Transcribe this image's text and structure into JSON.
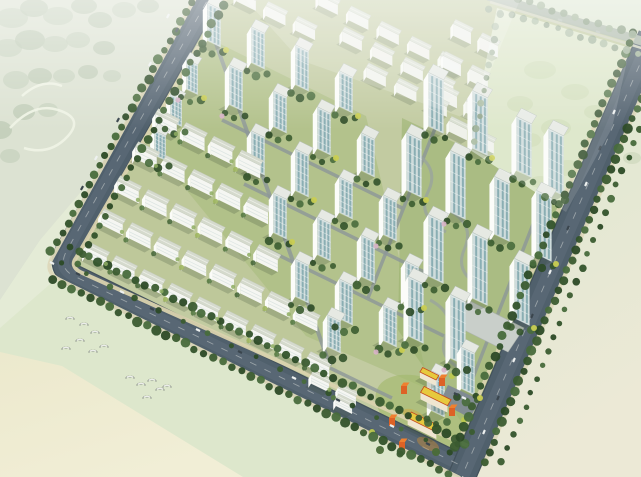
{
  "scene": {
    "kind": "aerial-masterplan-rendering",
    "palette": {
      "bg": "#eef1e2",
      "site_base": "#c2cba1",
      "road": "#50606c",
      "road_dark": "#43515b",
      "road_light": "#5d6d79",
      "ne_road": "#aab6a8",
      "sidewalk_in": "#d9d2ae",
      "sidewalk_out": "#ddd8ba",
      "tree_dark": [
        "#2c4a26",
        "#3b5c30",
        "#486c3c",
        "#33532b"
      ],
      "tree_muted": [
        "#93a88c",
        "#a3b69a",
        "#879c80"
      ],
      "tree_row": [
        "#567a43",
        "#48683a",
        "#9fb65f"
      ],
      "accent_yellow": "#c9ce52",
      "accent_pink": "#d8b2c8",
      "wall": "#f5f6f2",
      "wall_end": "#fbfcf9",
      "wall_faded": "#f3f5f1",
      "roof_slab": "#d5dacd",
      "roof_slab_faded": "#dde2d8",
      "roof_tower": "#e6e9e3",
      "window_face": "#cfdcdc",
      "window_stripe": "#7ea6ad",
      "floor_line": "#d8e2df",
      "shadow": "rgba(55,75,50,0.22)",
      "school_roof": "#e7c93e",
      "school_wall": "#efe6d0",
      "school_cube": "#dd6226",
      "school_cube_roof": "#ef8030",
      "school_trim": "#c44a1e",
      "plaza": "#7e8994",
      "field_green_1": "#e4ebd6",
      "field_green_2": "#dde7cc",
      "field_cream_1": "#efecd0",
      "field_cream_2": "#e9e5c2",
      "forest_base": "#ccd6c0",
      "forest_blob_a": "#b2c1a6",
      "forest_blob_b": "#a5b69a",
      "ne_field": "#d9e4c4",
      "ne_blob": "#c8d7ae",
      "car_light": "#eef1f0",
      "car_dark": "#3a454d",
      "car_mid": "#b9c2b8",
      "bird": "#8d948a",
      "path_gray": "#98a39f",
      "street": "#8d9799",
      "podium": "#c9cfca",
      "lawn_low": "#bcc795",
      "lawn_mid": "#a3ba78",
      "lawn_high": "#97b16c"
    },
    "forest": {
      "poly": "0,0 208,0 140,122 40,240 0,300",
      "blobs": [
        [
          12,
          18,
          16,
          10
        ],
        [
          34,
          8,
          14,
          9
        ],
        [
          58,
          16,
          15,
          9
        ],
        [
          84,
          6,
          13,
          8
        ],
        [
          8,
          48,
          14,
          9
        ],
        [
          30,
          40,
          15,
          10
        ],
        [
          55,
          44,
          13,
          8
        ],
        [
          100,
          20,
          12,
          8
        ],
        [
          124,
          10,
          12,
          8
        ],
        [
          148,
          6,
          11,
          7
        ],
        [
          78,
          40,
          12,
          8
        ],
        [
          104,
          48,
          11,
          7
        ],
        [
          16,
          80,
          13,
          9
        ],
        [
          40,
          76,
          12,
          8
        ],
        [
          64,
          76,
          11,
          7
        ],
        [
          88,
          72,
          10,
          7
        ],
        [
          112,
          76,
          9,
          6
        ],
        [
          24,
          112,
          11,
          8
        ],
        [
          48,
          110,
          10,
          7
        ],
        [
          0,
          130,
          12,
          9
        ],
        [
          10,
          156,
          10,
          7
        ]
      ]
    },
    "fields": {
      "left_poly": "0,0 212,0 62,262 50,284 0,330",
      "green_strip_poly": "0,328 50,284 62,276 458,477 0,477",
      "cream_poly": "0,352 62,366 243,477 0,477",
      "right_poly": "641,88 641,477 470,477 479,466",
      "topright_poly": "494,0 641,0 641,40",
      "right_blobs": [
        [
          600,
          104,
          12,
          8
        ],
        [
          622,
          120,
          11,
          7
        ],
        [
          608,
          140,
          10,
          7
        ],
        [
          632,
          158,
          9,
          6
        ],
        [
          596,
          170,
          8,
          6
        ]
      ],
      "ne_field_poly": "497,8 630,48 612,128 566,212 470,150 487,56",
      "ne_blobs": [
        [
          540,
          70,
          16,
          9
        ],
        [
          575,
          92,
          14,
          8
        ],
        [
          520,
          104,
          13,
          8
        ],
        [
          556,
          128,
          15,
          9
        ],
        [
          595,
          112,
          11,
          7
        ],
        [
          530,
          140,
          11,
          7
        ],
        [
          568,
          168,
          13,
          8
        ],
        [
          540,
          182,
          10,
          6
        ]
      ],
      "loops": [
        "M 10,128 q 24,-26 48,-18 q 26,8 10,26 q -18,20 -44,12",
        "M 22,96 q 20,-18 40,-10"
      ]
    },
    "site": {
      "base_poly": "252,-74 645,46 465,463 60,265",
      "lawns": [
        {
          "poly": "158,120 250,166 345,388 72,252",
          "fill": "#bcc795",
          "op": 0.55
        },
        {
          "poly": "200,34 366,116 430,390 306,336 152,148",
          "fill": "#a3ba78",
          "op": 0.5
        },
        {
          "poly": "402,118 582,202 478,446 398,330",
          "fill": "#97b16c",
          "op": 0.55
        }
      ],
      "school_lawn": {
        "cx": 426,
        "cy": 412,
        "rx": 54,
        "ry": 32,
        "rot": 26,
        "fill": "#a3b86d",
        "op": 0.65
      }
    },
    "streets": [
      [
        206,
        22,
        86,
        234,
        4.5
      ],
      [
        214,
        38,
        330,
        366,
        4
      ],
      [
        222,
        120,
        402,
        208,
        3.5
      ],
      [
        244,
        184,
        424,
        272,
        3.5
      ],
      [
        264,
        248,
        444,
        336,
        3.5
      ],
      [
        436,
        126,
        368,
        298,
        3.5
      ],
      [
        548,
        186,
        472,
        380,
        3.5
      ],
      [
        330,
        368,
        392,
        398,
        3.5
      ]
    ],
    "roads": {
      "main": [
        {
          "d": "M 230,-40 L 66,252 Q 58,268 74,276 L 466,468",
          "w": 21
        },
        {
          "d": "M 652,36 L 462,476",
          "w": 26
        }
      ],
      "ne": {
        "d": "M 488,-4 L 652,44",
        "w": 9
      },
      "dashes": [
        "M 230,-40 L 66,252 Q 58,268 74,276 L 466,468",
        "M 652,36 L 462,476"
      ],
      "sidewalks": [
        {
          "d": "M 240,-26 L 76,258 Q 70,266 80,272 L 468,446",
          "w": 4,
          "c": "#d9d2ae"
        },
        {
          "d": "M 216,-40 L 52,258 Q 44,272 60,280 L 460,478",
          "w": 4,
          "c": "#ddd8ba"
        },
        {
          "d": "M 636,30 L 456,448",
          "w": 4,
          "c": "#d9d2ae"
        },
        {
          "d": "M 664,44 L 484,464",
          "w": 4,
          "c": "#ddd8ba"
        },
        {
          "d": "M 490,2 L 648,50",
          "w": 2.5,
          "c": "#cfd2bd"
        }
      ]
    },
    "treerows": [
      [
        213,
        -36,
        49,
        256,
        11,
        4.2,
        "dark"
      ],
      [
        239,
        -24,
        75,
        268,
        11,
        4.0,
        "dark"
      ],
      [
        70,
        247,
        468,
        444,
        10.5,
        4.2,
        "dark"
      ],
      [
        53,
        279,
        456,
        477,
        10.5,
        4.4,
        "dark"
      ],
      [
        62,
        262,
        462,
        459,
        27,
        2.8,
        "dark"
      ],
      [
        634,
        33,
        454,
        450,
        11,
        4.2,
        "dark"
      ],
      [
        663,
        48,
        483,
        465,
        11,
        4.4,
        "dark"
      ],
      [
        668,
        60,
        500,
        468,
        15,
        3.4,
        "dark"
      ],
      [
        495,
        -8,
        650,
        40,
        12,
        3.8,
        "muted"
      ],
      [
        489,
        8,
        644,
        56,
        12,
        3.6,
        "muted"
      ],
      [
        499,
        14,
        473,
        146,
        13,
        3.2,
        "muted"
      ]
    ],
    "slabrows": [
      {
        "x": 166,
        "y": 132,
        "n": 4,
        "sp": 31,
        "len": 24,
        "dep": 7,
        "h": 13,
        "fade": 0
      },
      {
        "x": 146,
        "y": 164,
        "n": 5,
        "sp": 31,
        "len": 24,
        "dep": 7,
        "h": 12,
        "fade": 0
      },
      {
        "x": 128,
        "y": 198,
        "n": 6,
        "sp": 31,
        "len": 24,
        "dep": 7,
        "h": 12,
        "fade": 0
      },
      {
        "x": 112,
        "y": 230,
        "n": 8,
        "sp": 31,
        "len": 24,
        "dep": 7,
        "h": 11,
        "fade": 0
      },
      {
        "x": 96,
        "y": 262,
        "n": 9,
        "sp": 31,
        "len": 24,
        "dep": 7,
        "h": 10,
        "fade": 0
      },
      {
        "x": 320,
        "y": 388,
        "n": 2,
        "sp": 30,
        "len": 20,
        "dep": 6,
        "h": 9,
        "fade": 0
      },
      {
        "x": 344,
        "y": 410,
        "n": 1,
        "sp": 30,
        "len": 18,
        "dep": 6,
        "h": 8,
        "fade": 0
      },
      {
        "x": 246,
        "y": 6,
        "n": 3,
        "sp": 33,
        "len": 22,
        "dep": 6,
        "h": 10,
        "fade": 1
      },
      {
        "x": 328,
        "y": 10,
        "n": 5,
        "sp": 34,
        "len": 22,
        "dep": 6,
        "h": 10,
        "fade": 1
      },
      {
        "x": 352,
        "y": 46,
        "n": 4,
        "sp": 34,
        "len": 22,
        "dep": 6,
        "h": 10,
        "fade": 1
      },
      {
        "x": 376,
        "y": 82,
        "n": 3,
        "sp": 34,
        "len": 22,
        "dep": 6,
        "h": 10,
        "fade": 1
      },
      {
        "x": 462,
        "y": 40,
        "n": 2,
        "sp": 30,
        "len": 20,
        "dep": 6,
        "h": 12,
        "fade": 1
      },
      {
        "x": 452,
        "y": 72,
        "n": 2,
        "sp": 30,
        "len": 20,
        "dep": 6,
        "h": 12,
        "fade": 1
      },
      {
        "x": 448,
        "y": 104,
        "n": 2,
        "sp": 30,
        "len": 20,
        "dep": 6,
        "h": 12,
        "fade": 1
      },
      {
        "x": 458,
        "y": 136,
        "n": 2,
        "sp": 30,
        "len": 20,
        "dep": 6,
        "h": 11,
        "fade": 1
      }
    ],
    "towers": [
      [
        192,
        92,
        30,
        13,
        9
      ],
      [
        176,
        124,
        27,
        13,
        9
      ],
      [
        160,
        158,
        25,
        13,
        9
      ],
      [
        214,
        44,
        38
      ],
      [
        258,
        66,
        36
      ],
      [
        302,
        88,
        40
      ],
      [
        346,
        110,
        36
      ],
      [
        236,
        108,
        40
      ],
      [
        280,
        130,
        36
      ],
      [
        324,
        152,
        42
      ],
      [
        368,
        174,
        38
      ],
      [
        258,
        172,
        38
      ],
      [
        302,
        194,
        42
      ],
      [
        346,
        216,
        36
      ],
      [
        390,
        238,
        40
      ],
      [
        280,
        236,
        40
      ],
      [
        324,
        258,
        38
      ],
      [
        368,
        280,
        42
      ],
      [
        412,
        302,
        38
      ],
      [
        302,
        300,
        38
      ],
      [
        346,
        322,
        40
      ],
      [
        390,
        344,
        36
      ],
      [
        334,
        350,
        32
      ],
      [
        436,
        130,
        54,
        17,
        11
      ],
      [
        480,
        152,
        58,
        17,
        11
      ],
      [
        524,
        174,
        54,
        17,
        11
      ],
      [
        556,
        192,
        60,
        17,
        11
      ],
      [
        414,
        194,
        58,
        17,
        11
      ],
      [
        458,
        216,
        62,
        17,
        11
      ],
      [
        502,
        238,
        58,
        17,
        11
      ],
      [
        544,
        258,
        64,
        17,
        11
      ],
      [
        436,
        280,
        62,
        17,
        11
      ],
      [
        480,
        302,
        66,
        17,
        11
      ],
      [
        522,
        322,
        60,
        17,
        11
      ],
      [
        416,
        340,
        60,
        17,
        11
      ],
      [
        458,
        362,
        64,
        17,
        11
      ],
      [
        468,
        392,
        42,
        15,
        10
      ],
      [
        438,
        414,
        40,
        15,
        10
      ]
    ],
    "podium": {
      "poly": "468,300 524,328 508,352 452,324",
      "fill": "#c9cfca"
    },
    "school": {
      "bldgs": [
        {
          "x": 428,
          "y": 382,
          "len": 18,
          "dep": 6,
          "h": 6
        },
        {
          "x": 434,
          "y": 406,
          "len": 30,
          "dep": 8,
          "h": 7
        },
        {
          "x": 422,
          "y": 432,
          "len": 32,
          "dep": 8,
          "h": 7
        }
      ],
      "cubes": [
        [
          404,
          394
        ],
        [
          392,
          426
        ],
        [
          452,
          416
        ],
        [
          402,
          450
        ],
        [
          442,
          386
        ]
      ],
      "plaza_poly": "448,385 480,400 470,418 440,402",
      "courts": [
        [
          414,
          416,
          12,
          5.5,
          "#d1a83e",
          0.5
        ],
        [
          428,
          444,
          12,
          5.5,
          "#cc8f35",
          0.45
        ]
      ],
      "trees": [
        [
          380,
          450,
          4,
          "#4a6b38"
        ],
        [
          400,
          454,
          3.5,
          "#3b5c30"
        ],
        [
          436,
          452,
          4,
          "#4a6b38"
        ],
        [
          458,
          444,
          3.5,
          "#33532b"
        ],
        [
          472,
          432,
          3,
          "#3b5c30"
        ],
        [
          372,
          432,
          3,
          "#bcc84e"
        ],
        [
          452,
          376,
          3,
          "#bcc84e"
        ],
        [
          464,
          420,
          3,
          "#bcc84e"
        ]
      ]
    },
    "hipaths": [
      "M 414,152 q 26,16 14,40 q -12,24 18,40",
      "M 448,210 q 28,14 16,40 q -10,24 20,38",
      "M 430,300 q 26,14 16,36 q -10,22 18,34"
    ],
    "cars": [
      [
        168,
        16,
        119,
        "L"
      ],
      [
        177,
        30,
        119,
        "D"
      ],
      [
        150,
        64,
        119,
        "L"
      ],
      [
        118,
        120,
        119,
        "D"
      ],
      [
        96,
        158,
        119,
        "L"
      ],
      [
        82,
        188,
        119,
        "D"
      ],
      [
        52,
        263,
        26,
        "L"
      ],
      [
        78,
        274,
        26,
        "D"
      ],
      [
        122,
        292,
        26,
        "L"
      ],
      [
        152,
        309,
        26,
        "D"
      ],
      [
        198,
        330,
        26,
        "L"
      ],
      [
        240,
        352,
        26,
        "D"
      ],
      [
        294,
        378,
        26,
        "L"
      ],
      [
        338,
        400,
        26,
        "D"
      ],
      [
        392,
        426,
        26,
        "L"
      ],
      [
        428,
        444,
        26,
        "D"
      ],
      [
        614,
        112,
        113,
        "L"
      ],
      [
        600,
        148,
        113,
        "D"
      ],
      [
        586,
        184,
        113,
        "L"
      ],
      [
        568,
        228,
        113,
        "D"
      ],
      [
        550,
        272,
        113,
        "L"
      ],
      [
        532,
        316,
        113,
        "D"
      ],
      [
        514,
        360,
        113,
        "L"
      ],
      [
        498,
        398,
        113,
        "D"
      ],
      [
        484,
        432,
        113,
        "L"
      ],
      [
        560,
        20,
        17,
        "M"
      ],
      [
        598,
        32,
        17,
        "M"
      ],
      [
        456,
        394,
        26,
        "D"
      ],
      [
        464,
        398,
        26,
        "L"
      ]
    ],
    "birds": {
      "flocks": [
        [
          [
            84,
            325
          ],
          [
            95,
            333
          ],
          [
            70,
            319
          ],
          [
            66,
            349
          ],
          [
            80,
            341
          ],
          [
            93,
            352
          ],
          [
            104,
            347
          ]
        ],
        [
          [
            130,
            378
          ],
          [
            141,
            385
          ],
          [
            152,
            381
          ],
          [
            160,
            390
          ],
          [
            167,
            387
          ],
          [
            147,
            398
          ]
        ]
      ]
    }
  }
}
